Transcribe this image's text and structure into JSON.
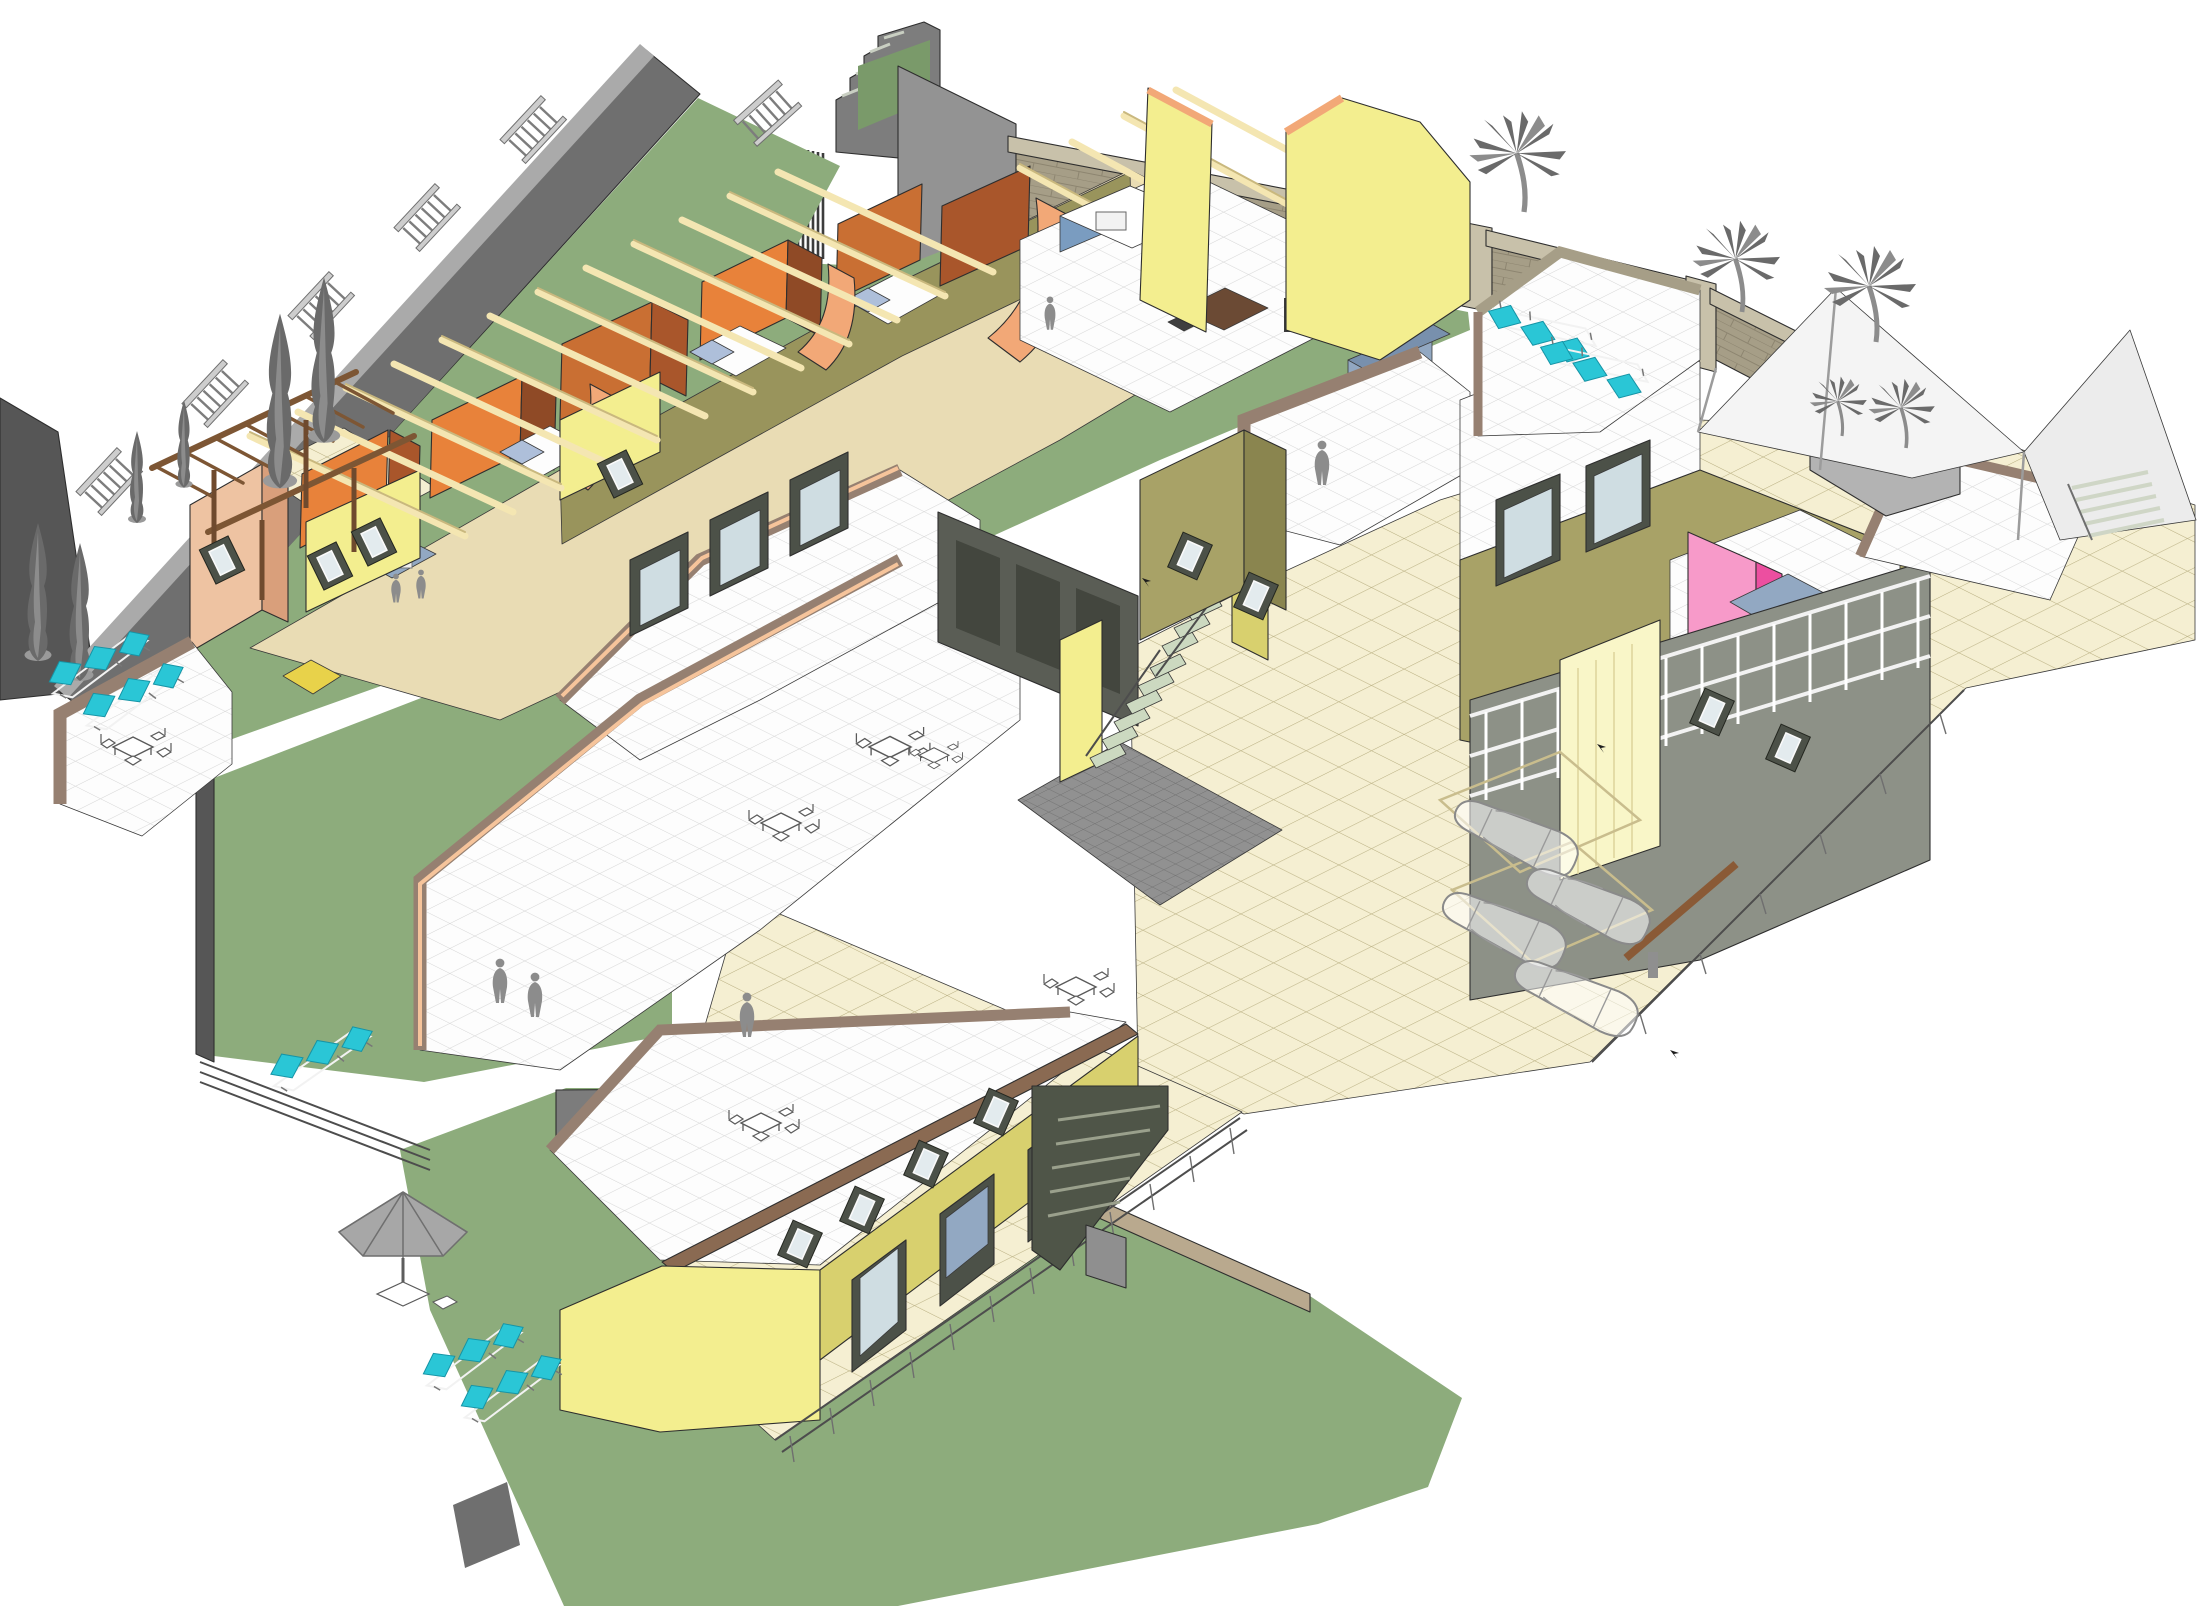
{
  "scene": {
    "description": "Axonometric cutaway 3D model of a terraced multi-unit residential complex with walled gardens, roof terraces, parking court and palm-shaded forecourt",
    "text_labels": []
  },
  "colors": {
    "bg": "#ffffff",
    "lawn": "#8dac7c",
    "lawn_dark": "#7a9a6a",
    "wall_gray": "#6f6f6f",
    "wall_gray_light": "#aaaaaa",
    "wall_gray_dark": "#565656",
    "brick_face": "#a69e87",
    "brick_top": "#c8c1aa",
    "brick_line": "#8d8570",
    "white_tile": "#fdfdfd",
    "tile_line": "#d5d5d5",
    "cream_tile": "#f5efd2",
    "cream_line": "#b8ae80",
    "cobble": "#919191",
    "cobble_line": "#6e6e6e",
    "orange_bright": "#e8823a",
    "orange_mid": "#c96f33",
    "orange_dark": "#a9562b",
    "brown_wall": "#8f4a26",
    "salmon": "#f2a877",
    "salmon_light": "#f6c49b",
    "beam": "#f4e6b2",
    "beam_edge": "#c9b87e",
    "yellow_wall": "#f3ee8f",
    "yellow_shade": "#d8d06e",
    "yellow_pale": "#f9f6c8",
    "olive_wall": "#a8a267",
    "olive_dark": "#8a854f",
    "khaki_floor": "#99945c",
    "tan_floor": "#e9dcb4",
    "peach_wall": "#eec3a2",
    "peach_dark": "#d99f7b",
    "pink": "#f79ac9",
    "magenta": "#ec4fa0",
    "cyan": "#2ac6d6",
    "cyan_dark": "#1694a6",
    "sofa": "#92a8c2",
    "sofa_dark": "#7890ad",
    "bed_blue": "#aebfda",
    "bed_yellow": "#e8d24a",
    "shutter": "#4c5148",
    "glass": "#cfdde2",
    "stair_tread": "#ccd9c0",
    "garage": "#5a5d55",
    "wood": "#7d5634",
    "entourage": "#8c8c8c",
    "entourage_dark": "#6a6a6a",
    "canopy": "#f4f4f4"
  },
  "entourage": {
    "cypresses": [
      {
        "x": 38,
        "y": 652,
        "s": 1.5
      },
      {
        "x": 80,
        "y": 672,
        "s": 1.5
      },
      {
        "x": 137,
        "y": 517,
        "s": 1.0
      },
      {
        "x": 184,
        "y": 482,
        "s": 0.95
      },
      {
        "x": 280,
        "y": 477,
        "s": 1.9
      },
      {
        "x": 324,
        "y": 432,
        "s": 1.8
      }
    ],
    "palms": [
      {
        "x": 1524,
        "y": 212,
        "s": 1.05
      },
      {
        "x": 1742,
        "y": 312,
        "s": 0.95
      },
      {
        "x": 1876,
        "y": 342,
        "s": 1.0
      },
      {
        "x": 1906,
        "y": 448,
        "s": 0.72
      },
      {
        "x": 1842,
        "y": 436,
        "s": 0.62
      }
    ],
    "loungers": [
      {
        "x": 96,
        "y": 668,
        "r": -26
      },
      {
        "x": 130,
        "y": 700,
        "r": -26
      },
      {
        "x": 318,
        "y": 1062,
        "r": -24
      },
      {
        "x": 470,
        "y": 1360,
        "r": -26
      },
      {
        "x": 508,
        "y": 1392,
        "r": -26
      },
      {
        "x": 1548,
        "y": 330,
        "r": 203
      },
      {
        "x": 1600,
        "y": 366,
        "r": 203
      }
    ],
    "tables": [
      {
        "x": 133,
        "y": 748,
        "s": 1.0
      },
      {
        "x": 890,
        "y": 748,
        "s": 1.05
      },
      {
        "x": 781,
        "y": 824,
        "s": 1.0
      },
      {
        "x": 1076,
        "y": 988,
        "s": 1.0
      },
      {
        "x": 761,
        "y": 1124,
        "s": 1.0
      },
      {
        "x": 934,
        "y": 756,
        "s": 0.75
      }
    ],
    "people": [
      {
        "x": 500,
        "y": 990,
        "s": 1.0
      },
      {
        "x": 535,
        "y": 1004,
        "s": 1.0
      },
      {
        "x": 747,
        "y": 1024,
        "s": 1.0
      },
      {
        "x": 1322,
        "y": 472,
        "s": 1.0
      },
      {
        "x": 1050,
        "y": 320,
        "s": 0.75
      },
      {
        "x": 396,
        "y": 594,
        "s": 0.65
      },
      {
        "x": 421,
        "y": 590,
        "s": 0.65
      }
    ],
    "cars": [
      {
        "x": 1516,
        "y": 838,
        "r": 25
      },
      {
        "x": 1588,
        "y": 906,
        "r": 25
      },
      {
        "x": 1504,
        "y": 930,
        "r": 25
      },
      {
        "x": 1576,
        "y": 998,
        "r": 25
      }
    ],
    "balustrades": [
      {
        "x": 114,
        "y": 486,
        "r": -47
      },
      {
        "x": 220,
        "y": 398,
        "r": -47
      },
      {
        "x": 326,
        "y": 310,
        "r": -47
      },
      {
        "x": 432,
        "y": 222,
        "r": -47
      },
      {
        "x": 538,
        "y": 134,
        "r": -47
      },
      {
        "x": 772,
        "y": 118,
        "r": -42
      }
    ],
    "windows": [
      {
        "x": 330,
        "y": 566,
        "r": -26
      },
      {
        "x": 374,
        "y": 542,
        "r": -26
      },
      {
        "x": 620,
        "y": 474,
        "r": -26
      },
      {
        "x": 800,
        "y": 1244,
        "r": 24
      },
      {
        "x": 862,
        "y": 1210,
        "r": 24
      },
      {
        "x": 926,
        "y": 1164,
        "r": 24
      },
      {
        "x": 996,
        "y": 1112,
        "r": 24
      },
      {
        "x": 1190,
        "y": 556,
        "r": 24
      },
      {
        "x": 1256,
        "y": 596,
        "r": 24
      },
      {
        "x": 1712,
        "y": 712,
        "r": 24
      },
      {
        "x": 1788,
        "y": 748,
        "r": 24
      },
      {
        "x": 222,
        "y": 560,
        "r": -26
      }
    ],
    "birds": [
      {
        "x": 1597,
        "y": 744
      },
      {
        "x": 1670,
        "y": 1050
      },
      {
        "x": 1142,
        "y": 578
      }
    ]
  }
}
